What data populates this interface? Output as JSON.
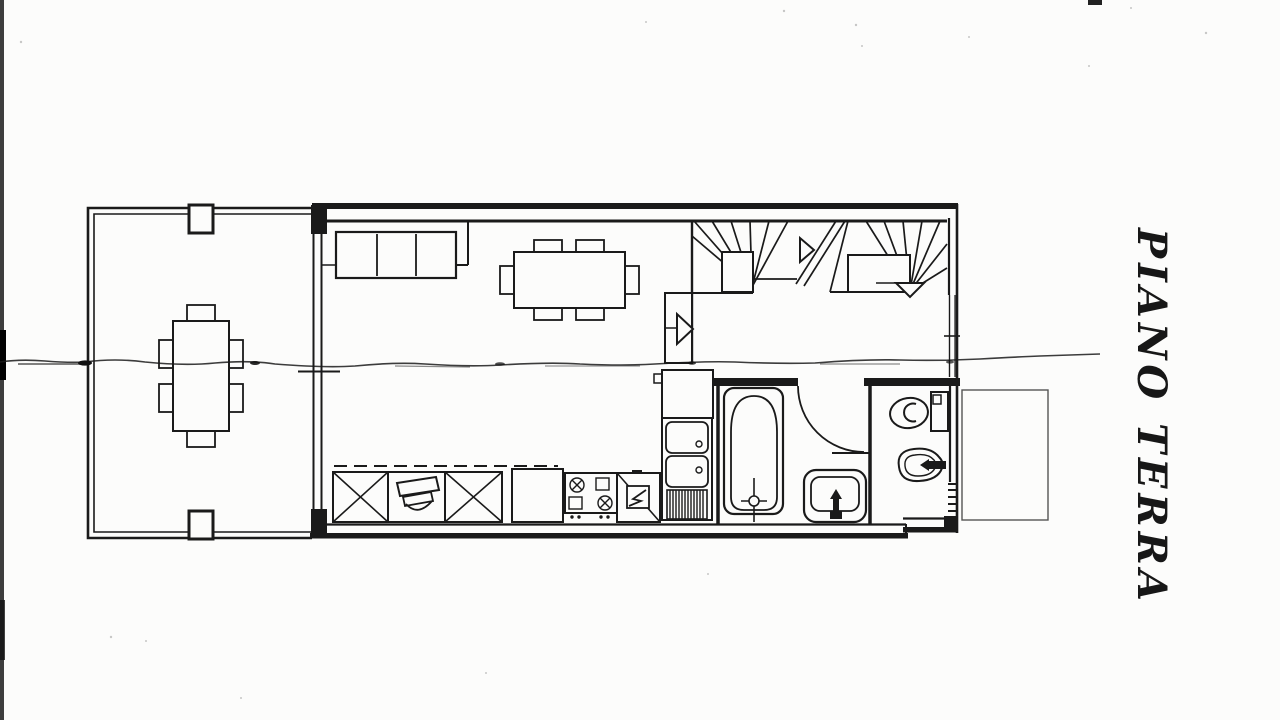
{
  "floor_label": {
    "text": "PIANO TERRA"
  },
  "colors": {
    "paper": "#fcfcfb",
    "ink": "#1a1a1a",
    "annex_outline": "#555555"
  },
  "drawing": {
    "type": "scanned architectural floor plan, ground floor",
    "fixtures": [
      "terrace",
      "terrace-pillars",
      "outdoor-dining-table",
      "outdoor-chairs",
      "sofa",
      "dining-table",
      "dining-chairs",
      "staircase-winder",
      "stair-direction-arrows",
      "entry-step-arrow",
      "kitchen-wall-cabinets-dashed",
      "kitchen-base-cabinet-x",
      "kitchen-sink-unit",
      "kitchen-cooktop",
      "kitchen-appliance-boiler",
      "kitchen-counter",
      "double-basin-sink",
      "refrigerator",
      "bathtub",
      "washbasin",
      "bathroom-door-swing",
      "toilet",
      "bidet",
      "window-left-wall",
      "window-right-wall",
      "annex-outline",
      "scan-artifact-line",
      "scanner-edge-strip"
    ]
  }
}
